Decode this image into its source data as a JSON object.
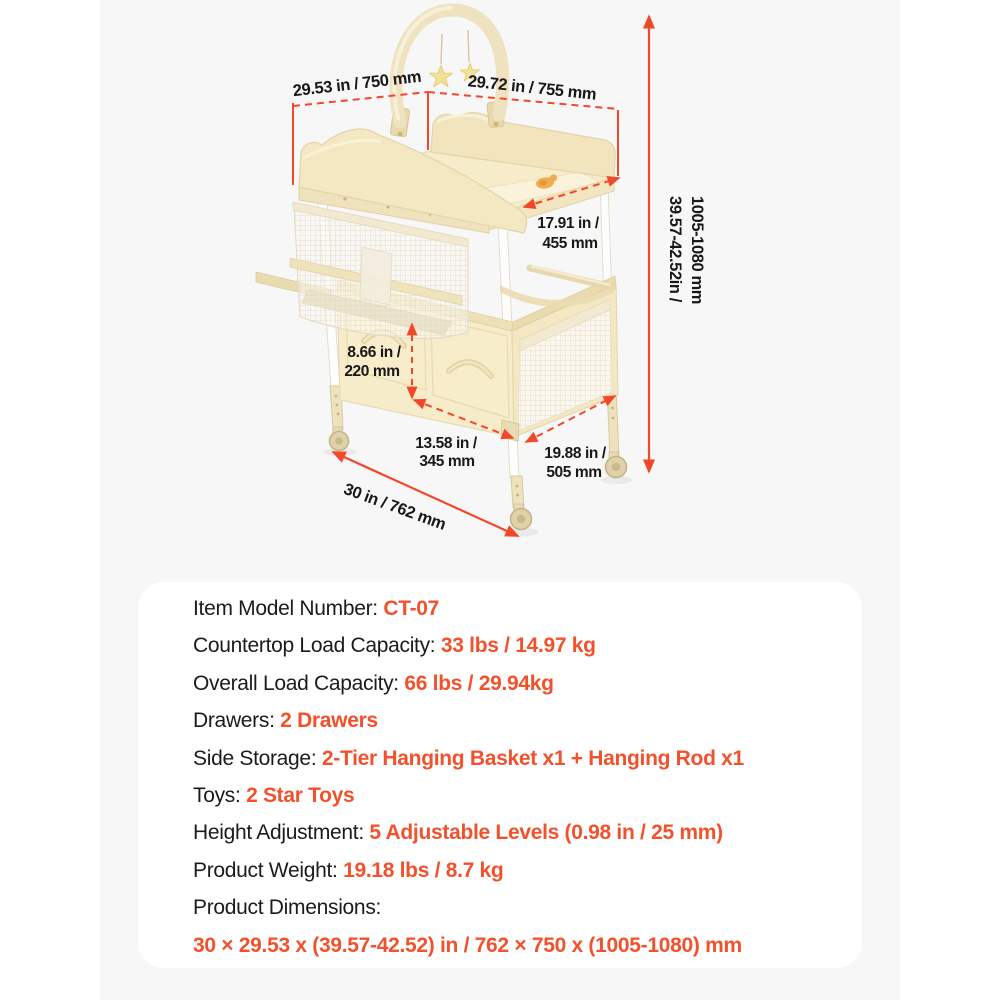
{
  "colors": {
    "accent_value_text": "#f2512c",
    "dimension_line": "#f2482a",
    "stage_background": "#f7f7f7",
    "panel_background": "#ffffff",
    "label_text": "#1b1b1b",
    "product_cream": "#f5e9c4"
  },
  "diagram": {
    "labels": {
      "top_left": "29.53 in / 750 mm",
      "top_right": "29.72 in / 755 mm",
      "height_l1": "39.57-42.52in /",
      "height_l2": "1005-1080 mm",
      "depth_l1": "17.91 in /",
      "depth_l2": "455 mm",
      "basket_l1": "8.66 in /",
      "basket_l2": "220 mm",
      "drawer_l1": "13.58 in /",
      "drawer_l2": "345 mm",
      "side_l1": "19.88 in /",
      "side_l2": "505 mm",
      "base": "30 in / 762 mm"
    }
  },
  "specs": {
    "rows": [
      {
        "label": "Item Model Number: ",
        "value": "CT-07"
      },
      {
        "label": "Countertop Load Capacity: ",
        "value": "33 lbs / 14.97 kg"
      },
      {
        "label": "Overall Load Capacity: ",
        "value": "66 lbs / 29.94kg"
      },
      {
        "label": "Drawers: ",
        "value": "2 Drawers"
      },
      {
        "label": "Side Storage: ",
        "value": "2-Tier Hanging Basket x1 + Hanging Rod x1"
      },
      {
        "label": "Toys: ",
        "value": "2 Star Toys"
      },
      {
        "label": "Height Adjustment: ",
        "value": "5 Adjustable Levels (0.98 in / 25 mm)"
      },
      {
        "label": "Product Weight: ",
        "value": "19.18 lbs / 8.7 kg"
      },
      {
        "label": "Product Dimensions:",
        "value": ""
      },
      {
        "label": "",
        "value": "30 × 29.53 x (39.57-42.52) in / 762 × 750 x (1005-1080) mm"
      }
    ]
  }
}
